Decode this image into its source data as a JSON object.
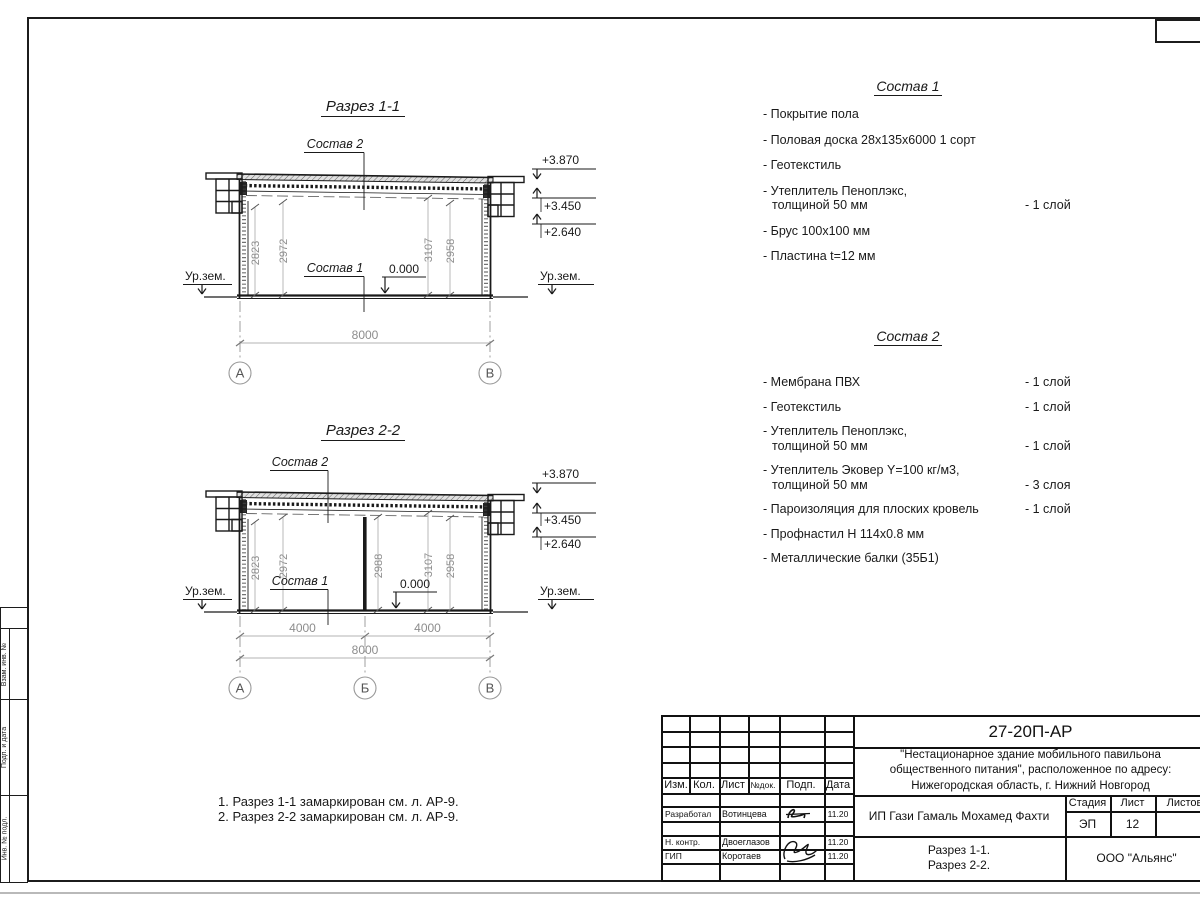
{
  "sheet": {
    "left_strip": {
      "cells": [
        "Взам. инв. №",
        "Подп. и дата",
        "Инв. № подл."
      ]
    },
    "notes": {
      "line1": "1. Разрез 1-1 замаркирован см. л. АР-9.",
      "line2": "2. Разрез 2-2 замаркирован см. л. АР-9."
    }
  },
  "section1": {
    "title": "Разрез 1-1",
    "sostav2_label": "Состав 2",
    "sostav1_label": "Состав 1",
    "zero_mark": "0.000",
    "ground_left": "Ур.зем.",
    "ground_right": "Ур.зем.",
    "elev_top": "+3.870",
    "elev_mid": "+3.450",
    "elev_low": "+2.640",
    "dim_v1": "2823",
    "dim_v2": "2972",
    "dim_v3": "3107",
    "dim_v4": "2958",
    "dim_span": "8000",
    "axis_a": "А",
    "axis_b": "В"
  },
  "section2": {
    "title": "Разрез 2-2",
    "sostav2_label": "Состав 2",
    "sostav1_label": "Состав 1",
    "zero_mark": "0.000",
    "ground_left": "Ур.зем.",
    "ground_right": "Ур.зем.",
    "elev_top": "+3.870",
    "elev_mid": "+3.450",
    "elev_low": "+2.640",
    "dim_v1": "2823",
    "dim_v2": "2972",
    "dim_v3": "2988",
    "dim_v4": "3107",
    "dim_v5": "2958",
    "dim_left": "4000",
    "dim_right": "4000",
    "dim_span": "8000",
    "axis_a": "А",
    "axis_mid": "Б",
    "axis_b": "В"
  },
  "composition1": {
    "title": "Состав 1",
    "items": [
      {
        "line1": "- Покрытие пола"
      },
      {
        "line1": "- Половая доска 28х135х6000 1 сорт"
      },
      {
        "line1": "- Геотекстиль"
      },
      {
        "line1": "- Утеплитель Пеноплэкс,",
        "line2": "толщиной 50 мм",
        "count": "- 1 слой"
      },
      {
        "line1": "- Брус 100х100 мм"
      },
      {
        "line1": "- Пластина t=12 мм"
      }
    ]
  },
  "composition2": {
    "title": "Состав 2",
    "items": [
      {
        "line1": "- Мембрана ПВХ",
        "count": "- 1 слой"
      },
      {
        "line1": "- Геотекстиль",
        "count": "- 1 слой"
      },
      {
        "line1": "- Утеплитель Пеноплэкс,",
        "line2": "толщиной 50 мм",
        "count": "- 1 слой"
      },
      {
        "line1": "- Утеплитель Эковер Y=100 кг/м3,",
        "line2": "толщиной 50 мм",
        "count": "- 3 слоя"
      },
      {
        "line1": "- Пароизоляция для плоских кровель",
        "count": "- 1 слой"
      },
      {
        "line1": "- Профнастил Н 114х0.8 мм"
      },
      {
        "line1": "- Металлические балки (35Б1)"
      }
    ]
  },
  "titleblock": {
    "doc_number": "27-20П-АР",
    "project_line1": "\"Нестационарное здание мобильного павильона",
    "project_line2": "общественного питания\", расположенное по адресу:",
    "project_line3": "Нижегородская область, г. Нижний Новгород",
    "client": "ИП Гази Гамаль Мохамед Фахти",
    "sheet_title_line1": "Разрез 1-1.",
    "sheet_title_line2": "Разрез 2-2.",
    "organization": "ООО \"Альянс\"",
    "headers": {
      "izm": "Изм.",
      "kol": "Кол.",
      "list": "Лист",
      "ndok": "№док.",
      "podp": "Подп.",
      "data": "Дата",
      "stadia": "Стадия",
      "list2": "Лист",
      "listov": "Листов"
    },
    "stadia_value": "ЭП",
    "list_value": "12",
    "listov_value": "",
    "rows": [
      {
        "role": "Разработал",
        "name": "Вотинцева",
        "date": "11.20"
      },
      {
        "role": "Н. контр.",
        "name": "Двоеглазов",
        "date": "11.20"
      },
      {
        "role": "ГИП",
        "name": "Коротаев",
        "date": "11.20"
      }
    ]
  }
}
